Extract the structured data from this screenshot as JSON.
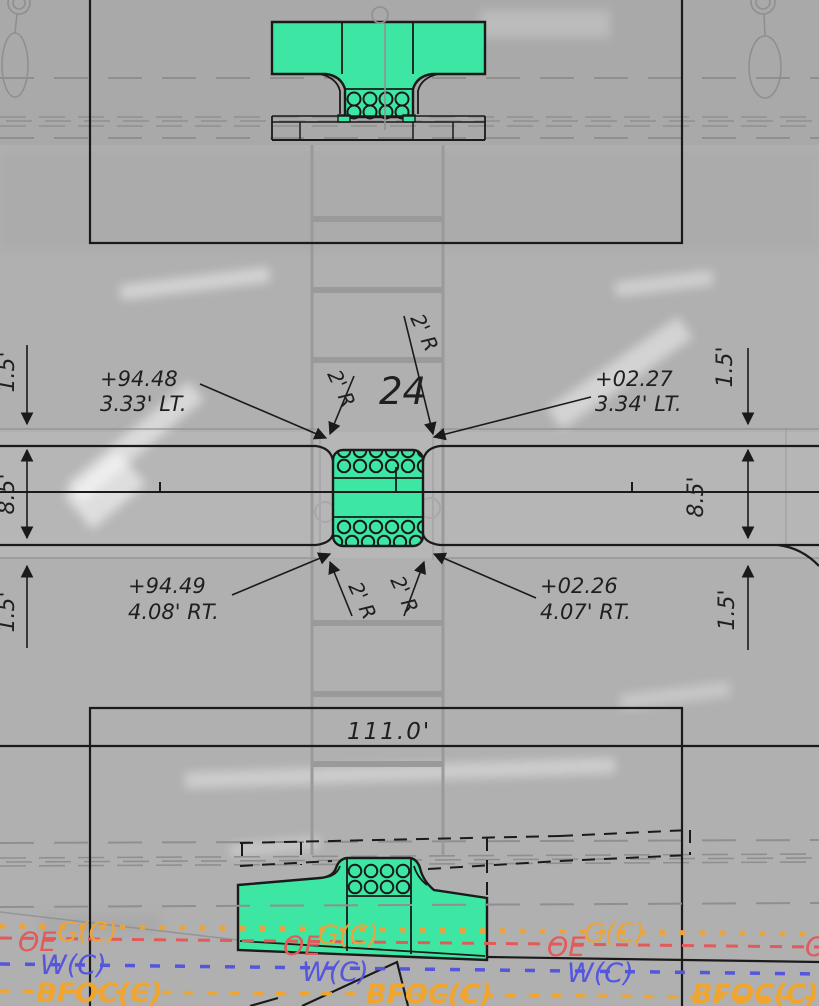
{
  "drawing": {
    "crossing_number": "24",
    "length_label": "111.0'",
    "radius_label": "2' R",
    "station_labels": {
      "top_left": {
        "line1": "+94.48",
        "line2": "3.33' LT."
      },
      "top_right": {
        "line1": "+02.27",
        "line2": "3.34' LT."
      },
      "bottom_left": {
        "line1": "+94.49",
        "line2": "4.08' RT."
      },
      "bottom_right": {
        "line1": "+02.26",
        "line2": "4.07' RT."
      }
    },
    "dimensions": {
      "left": [
        "1.5'",
        "8.5'",
        "1.5'"
      ],
      "right": [
        "1.5'",
        "8.5'",
        "1.5'"
      ]
    },
    "utilities": {
      "oe": {
        "label": "OE",
        "color": "#e25b5b"
      },
      "gc": {
        "label": "G(C)",
        "color": "#eaa43e"
      },
      "wc": {
        "label": "W(C)",
        "color": "#5456de"
      },
      "bfoc": {
        "label": "BFOC(C)",
        "color": "#f0a52f"
      }
    },
    "colors": {
      "highlight_green": "#3ee6a4",
      "line_black": "#1a1a1a",
      "base_gray": "#979797"
    }
  }
}
